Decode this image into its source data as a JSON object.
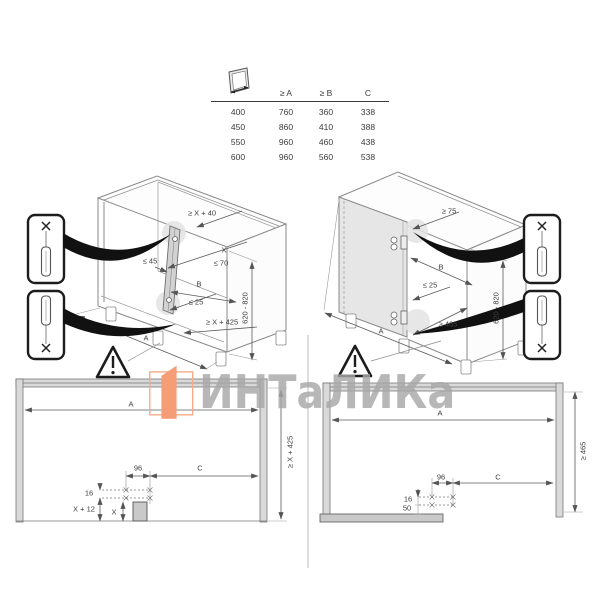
{
  "table": {
    "icon": "door-width-icon",
    "headers": [
      "≥ A",
      "≥ B",
      "C"
    ],
    "rows": [
      [
        "400",
        "760",
        "360",
        "338"
      ],
      [
        "450",
        "860",
        "410",
        "388"
      ],
      [
        "550",
        "960",
        "460",
        "438"
      ],
      [
        "600",
        "960",
        "560",
        "538"
      ]
    ]
  },
  "left_iso": {
    "top_clearance": "≥ X + 40",
    "x": "X",
    "max70": "≤ 70",
    "max45": "≤ 45",
    "b": "B",
    "max25": "≤ 25",
    "min_height": "≥ X + 425",
    "a": "A",
    "range": "620 - 820"
  },
  "right_iso": {
    "top_clearance": "≥ 75",
    "b": "B",
    "max25": "≤ 25",
    "min465": "≥ 465",
    "a": "A",
    "range": "620 - 820"
  },
  "left_plan": {
    "a": "A",
    "min_height": "≥ X + 425",
    "d96": "96",
    "c": "C",
    "d16": "16",
    "x12": "X + 12",
    "x": "X"
  },
  "right_plan": {
    "a": "A",
    "min465": "≥ 465",
    "d96": "96",
    "c": "C",
    "d16": "16",
    "d50": "50"
  },
  "watermark": {
    "text": "ИНТаЛИКа"
  },
  "colors": {
    "accent_orange": "#f59d76",
    "watermark_gray": "#a7a7a7",
    "line_gray": "#808080",
    "dim_gray": "#5a5a5a",
    "panel_fill": "#d9d9d9"
  },
  "icons": [
    "door-width-icon",
    "warning-triangle-icon",
    "rail-callout-top-icon",
    "rail-callout-bottom-icon",
    "swoosh-arrow",
    "intalika-logo-icon"
  ]
}
